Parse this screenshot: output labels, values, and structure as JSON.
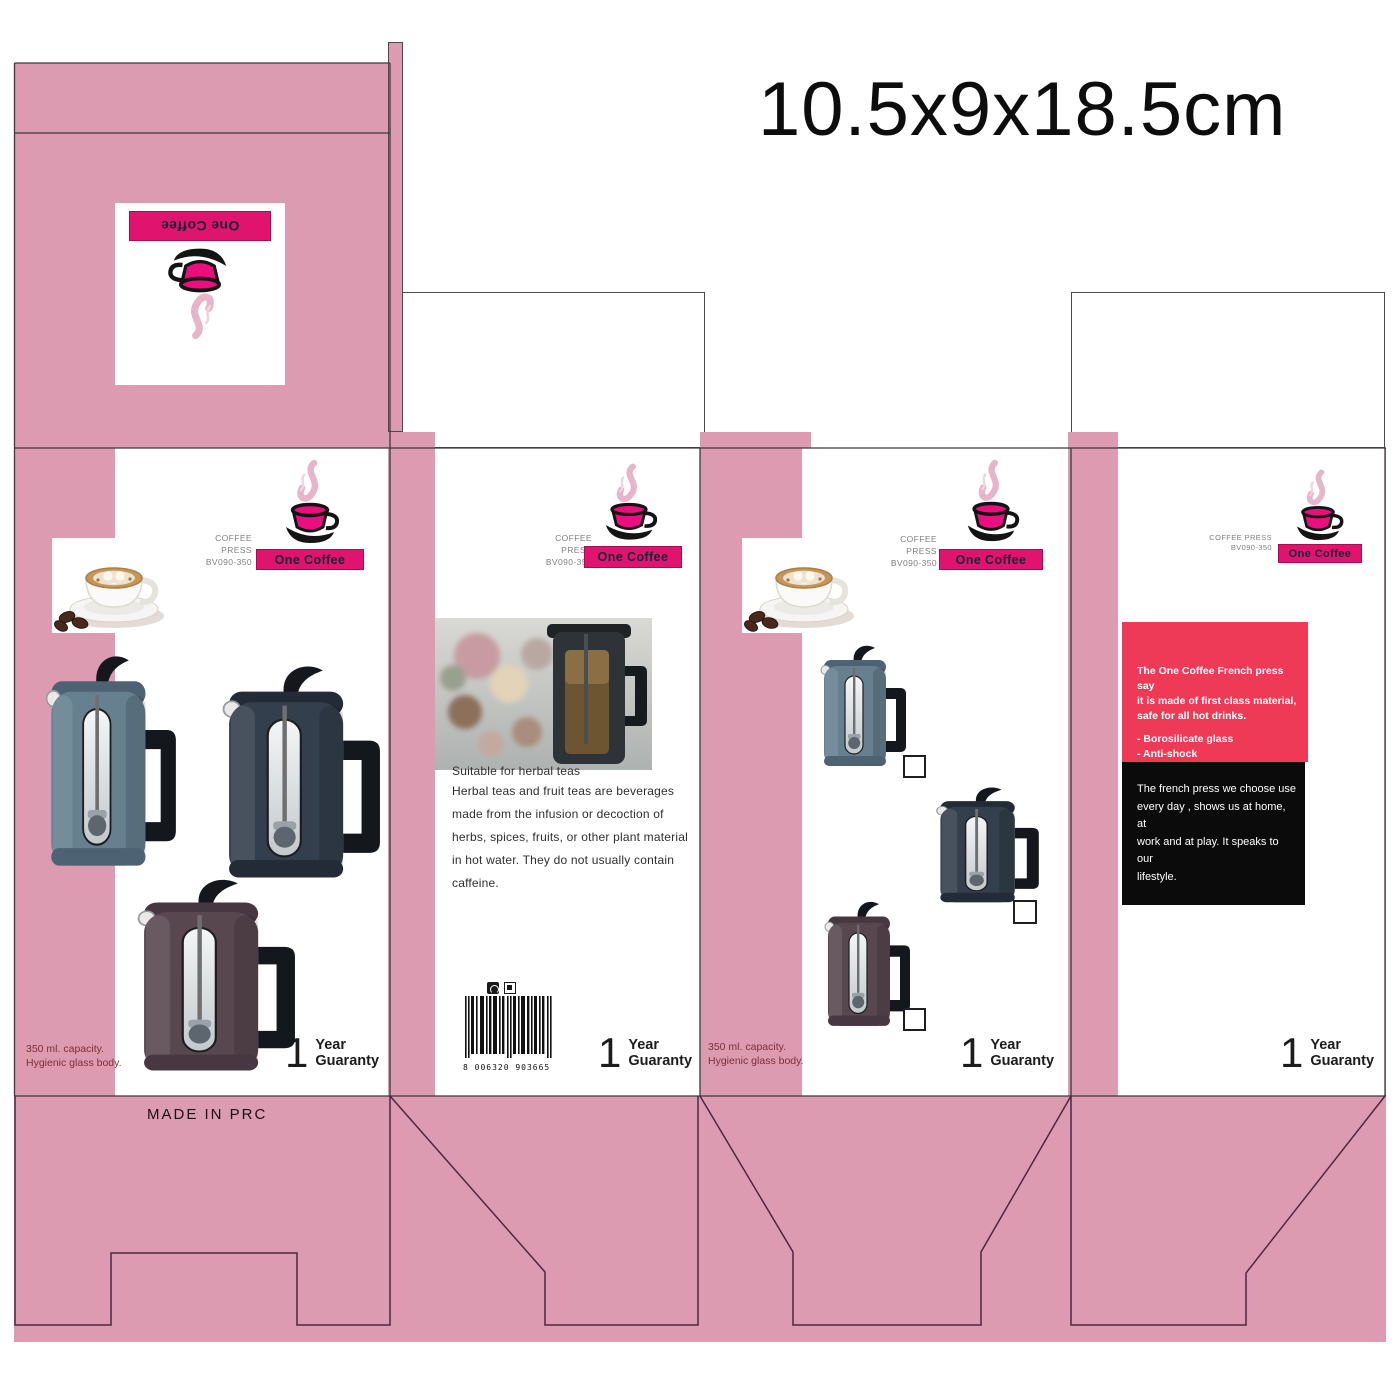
{
  "title": "10.5x9x18.5cm",
  "brand": {
    "name": "One Coffee"
  },
  "product": {
    "name": "COFFEE PRESS",
    "code": "BV090-350"
  },
  "made_in": "MADE IN PRC",
  "capacity": {
    "line1": "350 ml. capacity.",
    "line2": "Hygienic glass body."
  },
  "guaranty": {
    "number": "1",
    "word1": "Year",
    "word2": "Guaranty"
  },
  "herbal": {
    "title": "Suitable for herbal teas",
    "body": "Herbal teas and fruit teas are beverages\nmade from the infusion or decoction of\nherbs, spices, fruits, or other plant material\nin hot water. They do not usually contain\ncaffeine."
  },
  "barcode": {
    "number": "8 006320 903665"
  },
  "info_pink": {
    "intro": "The One Coffee French press say\nit is made of first class material,\nsafe for all hot drinks.",
    "bullets": [
      "- Borosilicate glass",
      "- Anti-shock",
      "- Anti Bacterial",
      "- 100% BPA free."
    ]
  },
  "info_black": {
    "text": "The french press we choose use\nevery day , shows us at home, at\nwork and at play. It speaks to our\nlifestyle."
  },
  "colors": {
    "background_pink": "#dc9bb1",
    "brand_magenta": "#e0146f",
    "logo_cup_pink": "#ea0e7f",
    "info_box_pink": "#ee3a57",
    "info_box_black": "#0b0b0b",
    "press_blue": "#66808f",
    "press_navy": "#333f4c",
    "press_brown": "#594750",
    "capacity_text": "#7b3038",
    "dieline_top": "#3a3a3a",
    "dieline_bottom": "#4e2740"
  }
}
